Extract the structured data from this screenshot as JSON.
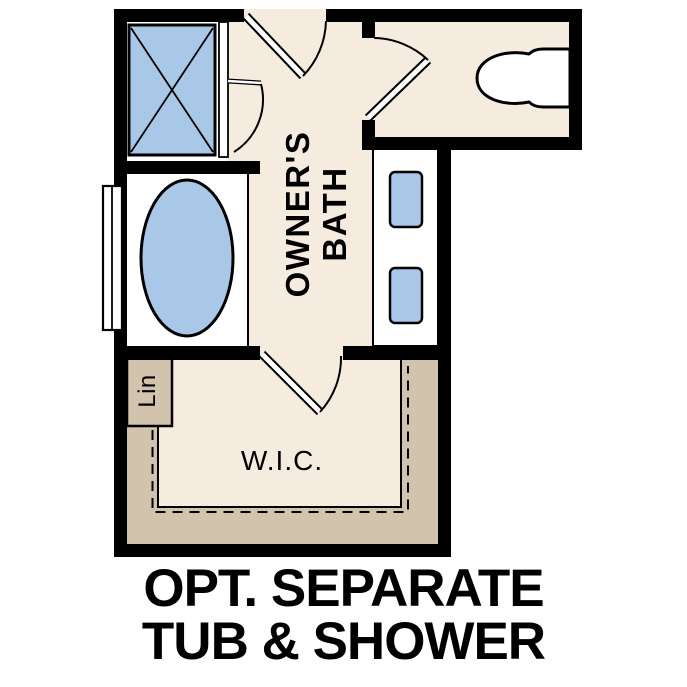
{
  "plan": {
    "rooms": {
      "bath_label": {
        "line1": "OWNER'S",
        "line2": "BATH"
      },
      "closet_label": "W.I.C.",
      "linen_label": "Lin"
    },
    "caption": {
      "line1": "OPT. SEPARATE",
      "line2": "TUB & SHOWER"
    }
  },
  "colors": {
    "floor_cream": "#f5ecdf",
    "cabinet_tan": "#d1c3ac",
    "fixture_blue": "#a9c8e8",
    "fixture_white": "#ffffff",
    "wall_black": "#000000",
    "text_black": "#000000"
  }
}
